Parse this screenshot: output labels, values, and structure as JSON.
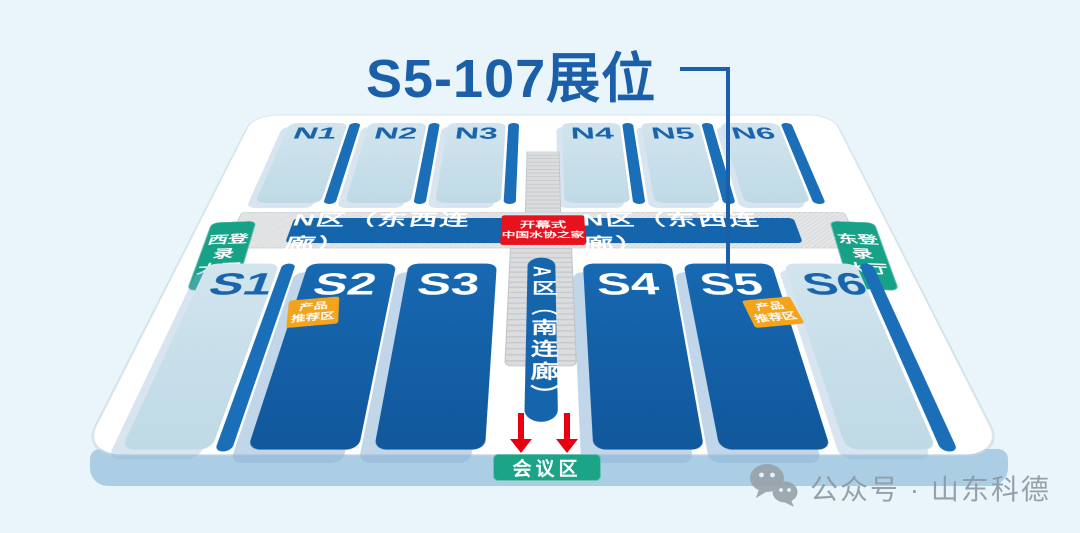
{
  "title": {
    "text": "S5-107展位"
  },
  "halls": {
    "north": [
      {
        "label": "N1"
      },
      {
        "label": "N2"
      },
      {
        "label": "N3"
      },
      {
        "label": "N4"
      },
      {
        "label": "N5"
      },
      {
        "label": "N6"
      }
    ],
    "south": [
      {
        "label": "S1"
      },
      {
        "label": "S2"
      },
      {
        "label": "S3"
      },
      {
        "label": "S4"
      },
      {
        "label": "S5"
      },
      {
        "label": "S6"
      }
    ]
  },
  "corridor": {
    "north_left_label": "N区（东西连廊）",
    "north_right_label": "N区（东西连廊）",
    "south_label": "A区（南连廊）"
  },
  "opening_badge": {
    "line1": "开幕式",
    "line2": "中国水协之家"
  },
  "entrances": {
    "west": {
      "lines": [
        "西登",
        "录",
        "大厅"
      ]
    },
    "east": {
      "lines": [
        "东登",
        "录",
        "大厅"
      ]
    }
  },
  "product_badge": {
    "line1": "产品",
    "line2": "推荐区"
  },
  "conference": {
    "label": "会议区"
  },
  "watermark": {
    "text": "公众号 · 山东科德"
  },
  "colors": {
    "background": "#e9f4fb",
    "title_blue": "#1b5fa8",
    "hall_light": "#c6dee9",
    "hall_dark": "#1565ab",
    "edge_stripe": "#1b6fb8",
    "corridor_gray": "#dcdee0",
    "badge_red": "#e8111e",
    "badge_orange": "#f3a41c",
    "badge_green": "#17a287",
    "conference_green": "#1ba487",
    "platform_blue": "#abcee4",
    "arrow_red": "#e60012",
    "watermark_gray": "#8e9aa3"
  }
}
